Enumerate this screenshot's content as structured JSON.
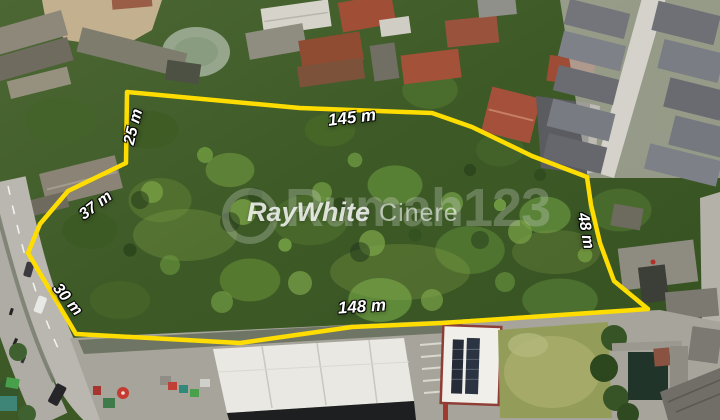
{
  "image": {
    "type": "aerial-drone-photo",
    "description": "Aerial view of a vacant treed land parcel outlined in yellow with side measurements, bordered by a road on the left, village roofs on top, a gray-roof housing complex on the right and commercial buildings at the bottom"
  },
  "overlay": {
    "boundary_color": "#ffdd00",
    "measurement_text_color": "#ffffff",
    "measurements": [
      {
        "label": "25 m",
        "side": "upper-left"
      },
      {
        "label": "145 m",
        "side": "top"
      },
      {
        "label": "37 m",
        "side": "left"
      },
      {
        "label": "48 m",
        "side": "right"
      },
      {
        "label": "30 m",
        "side": "lower-left"
      },
      {
        "label": "148 m",
        "side": "bottom"
      }
    ]
  },
  "watermarks": {
    "agency_brand": "RayWhite",
    "agency_office": "Cinere",
    "portal": "Rumah123"
  }
}
